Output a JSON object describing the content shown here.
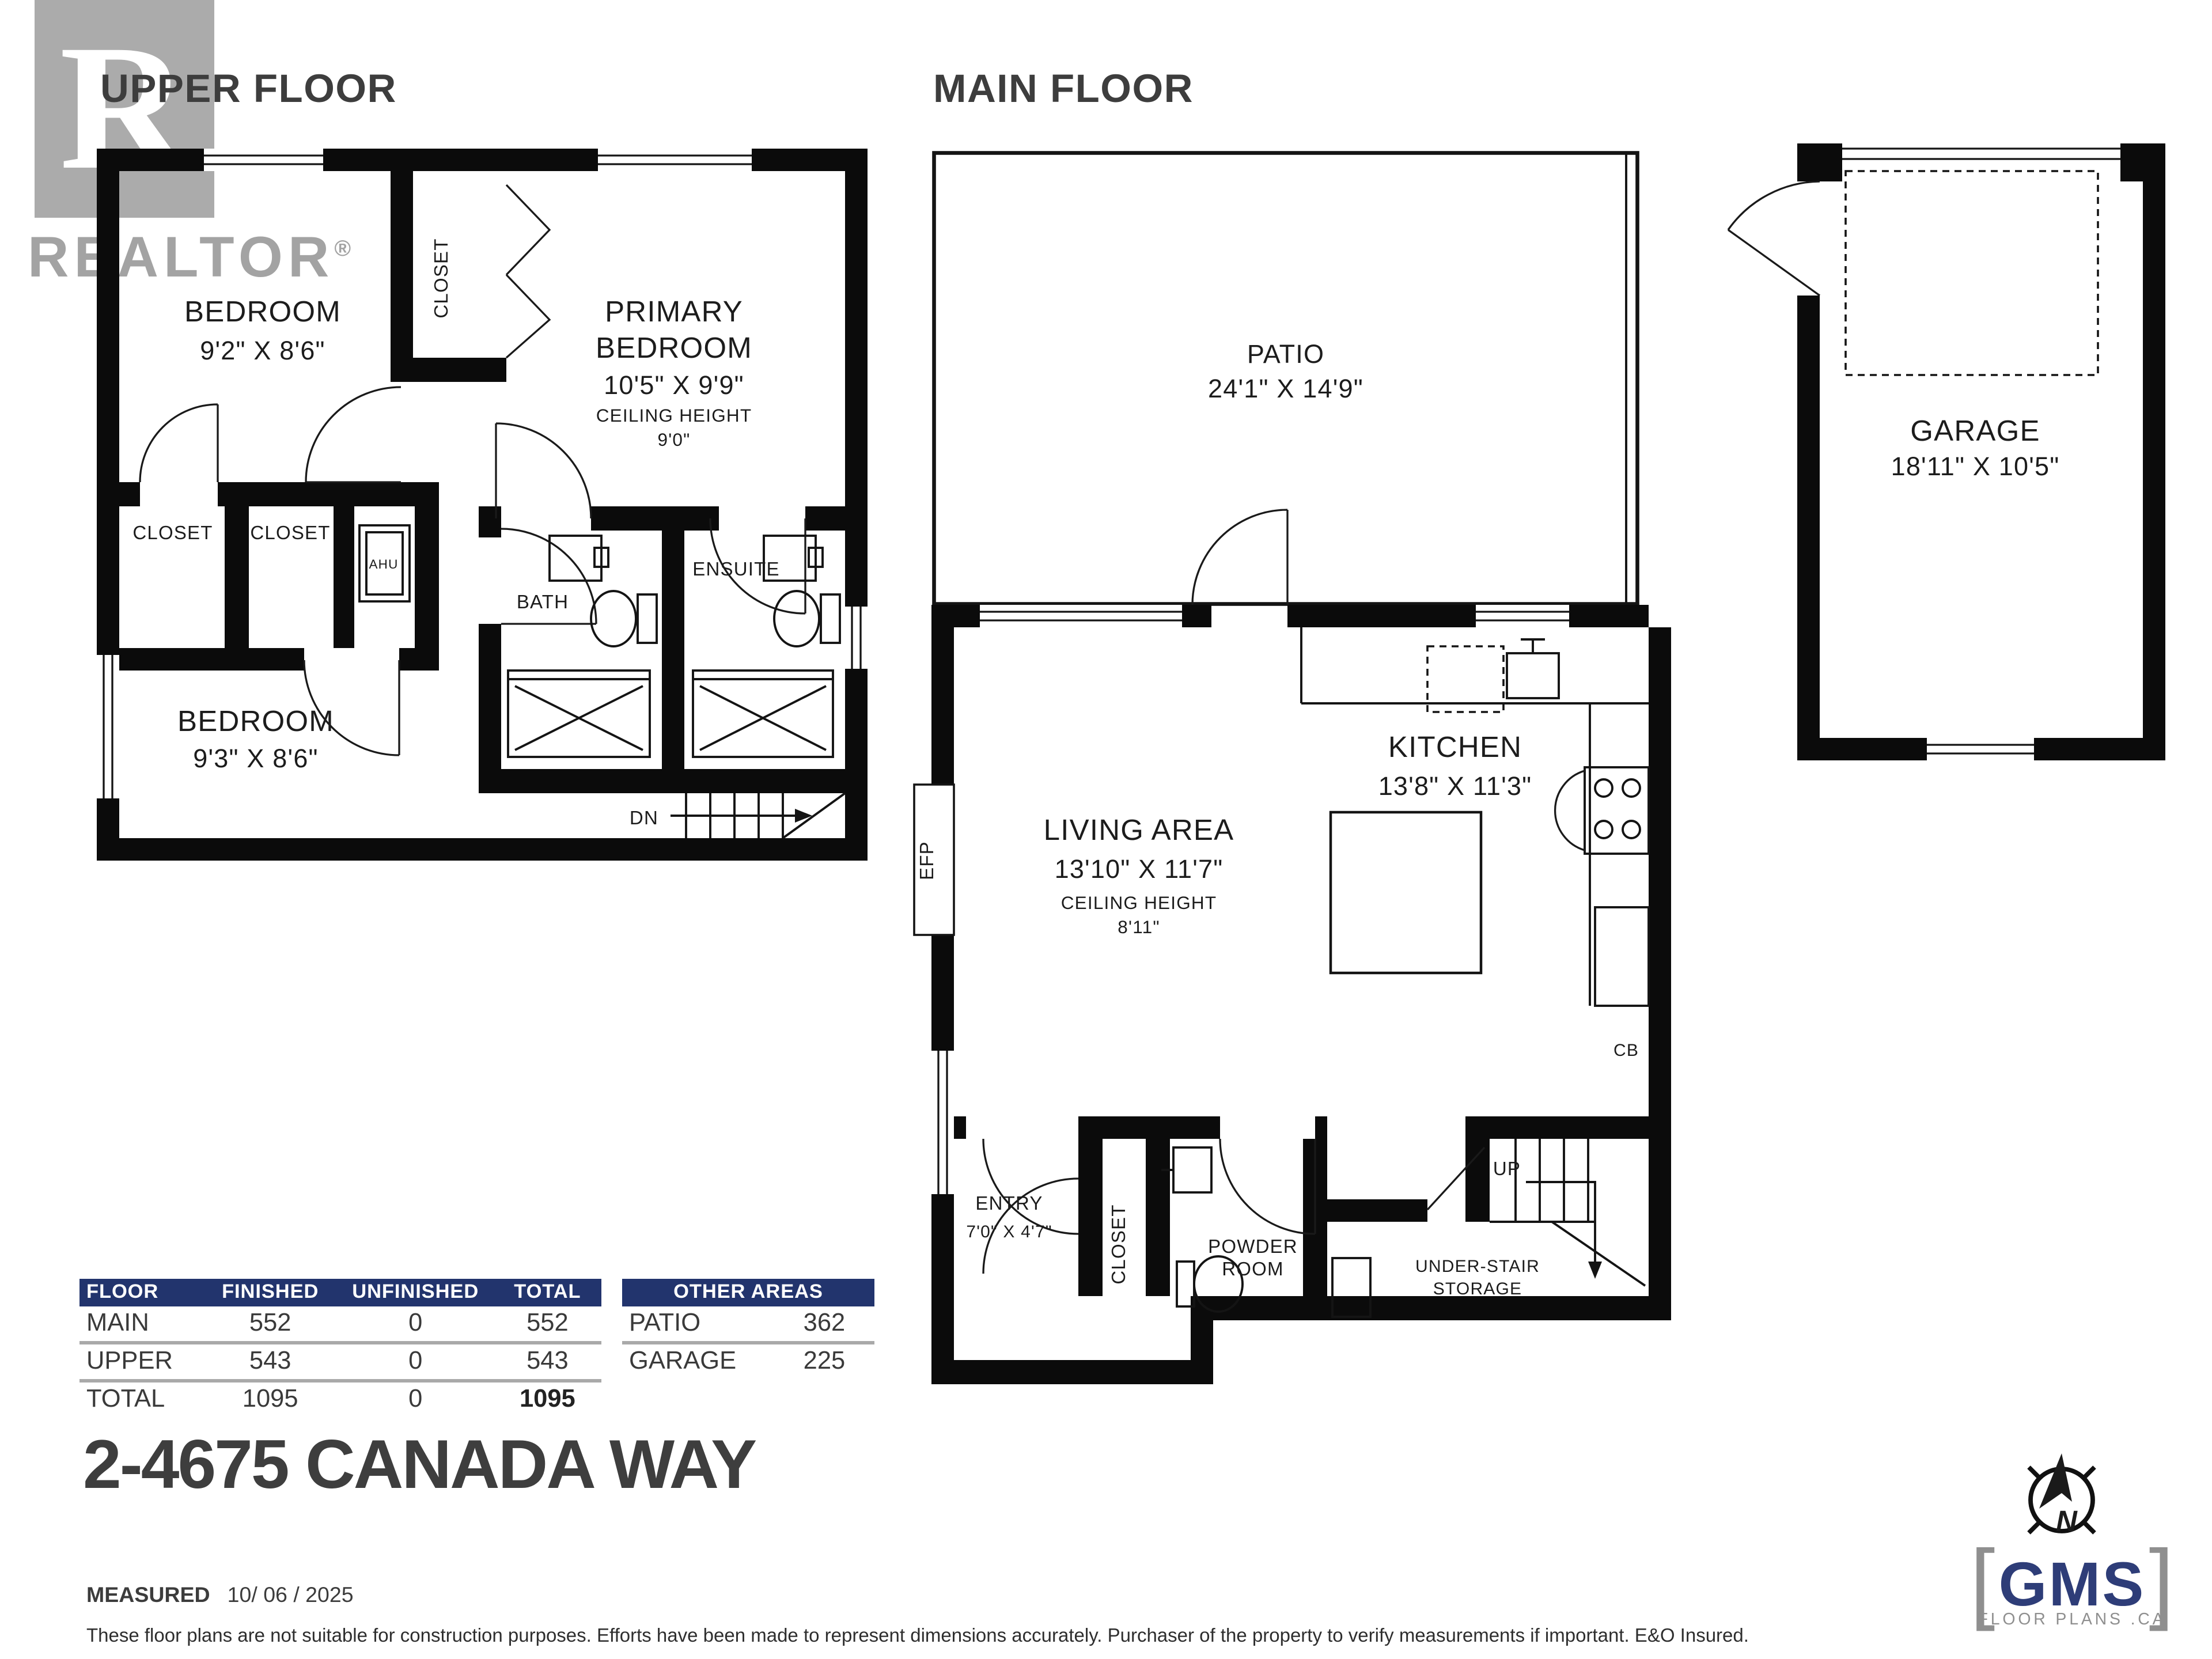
{
  "colors": {
    "accent_navy": "#22346d",
    "watermark_gray": "#ababab",
    "wall_black": "#0b0b0b",
    "title_gray": "#3d3d3d",
    "logo_navy": "#2e3d78"
  },
  "watermark": {
    "letter": "R",
    "brand": "REALTOR",
    "registered": "®"
  },
  "titles": {
    "upper": "UPPER FLOOR",
    "main": "MAIN FLOOR"
  },
  "upper_floor": {
    "bedroom1": {
      "name": "BEDROOM",
      "dims": "9'2\" X 8'6\""
    },
    "closet_top": "CLOSET",
    "primary": {
      "line1": "PRIMARY",
      "line2": "BEDROOM",
      "dims": "10'5\" X 9'9\"",
      "ceiling_label": "CEILING HEIGHT",
      "ceiling_value": "9'0\""
    },
    "closet_left": "CLOSET",
    "closet_mid": "CLOSET",
    "ahu": "AHU",
    "bedroom2": {
      "name": "BEDROOM",
      "dims": "9'3\" X 8'6\""
    },
    "bath": "BATH",
    "ensuite": "ENSUITE",
    "dn": "DN"
  },
  "main_floor": {
    "patio": {
      "name": "PATIO",
      "dims": "24'1\" X 14'9\""
    },
    "living": {
      "name": "LIVING AREA",
      "dims": "13'10\" X 11'7\"",
      "ceiling_label": "CEILING HEIGHT",
      "ceiling_value": "8'11\""
    },
    "kitchen": {
      "name": "KITCHEN",
      "dims": "13'8\" X 11'3\""
    },
    "efp": "EFP",
    "cb": "CB",
    "entry": {
      "name": "ENTRY",
      "dims": "7'0\" X 4'7\""
    },
    "closet": "CLOSET",
    "powder": {
      "line1": "POWDER",
      "line2": "ROOM"
    },
    "storage": {
      "line1": "UNDER-STAIR",
      "line2": "STORAGE"
    },
    "up": "UP"
  },
  "garage": {
    "name": "GARAGE",
    "dims": "18'11\" X 10'5\""
  },
  "area_table": {
    "headers": [
      "FLOOR",
      "FINISHED",
      "UNFINISHED",
      "TOTAL"
    ],
    "rows": [
      [
        "MAIN",
        "552",
        "0",
        "552"
      ],
      [
        "UPPER",
        "543",
        "0",
        "543"
      ]
    ],
    "total": [
      "TOTAL",
      "1095",
      "0",
      "1095"
    ]
  },
  "other_areas": {
    "header": "OTHER AREAS",
    "rows": [
      [
        "PATIO",
        "362"
      ],
      [
        "GARAGE",
        "225"
      ]
    ]
  },
  "address": "2-4675 CANADA WAY",
  "measured": {
    "label": "MEASURED",
    "date": "10/ 06 / 2025"
  },
  "disclaimer": "These floor plans are not suitable for construction purposes. Efforts have been made to represent dimensions accurately.  Purchaser of the property to verify measurements if important.  E&O Insured.",
  "logo": {
    "bracket_left": "[",
    "name": "GMS",
    "bracket_right": "]",
    "tagline": "FLOOR PLANS .CA"
  },
  "compass": {
    "n": "N"
  }
}
